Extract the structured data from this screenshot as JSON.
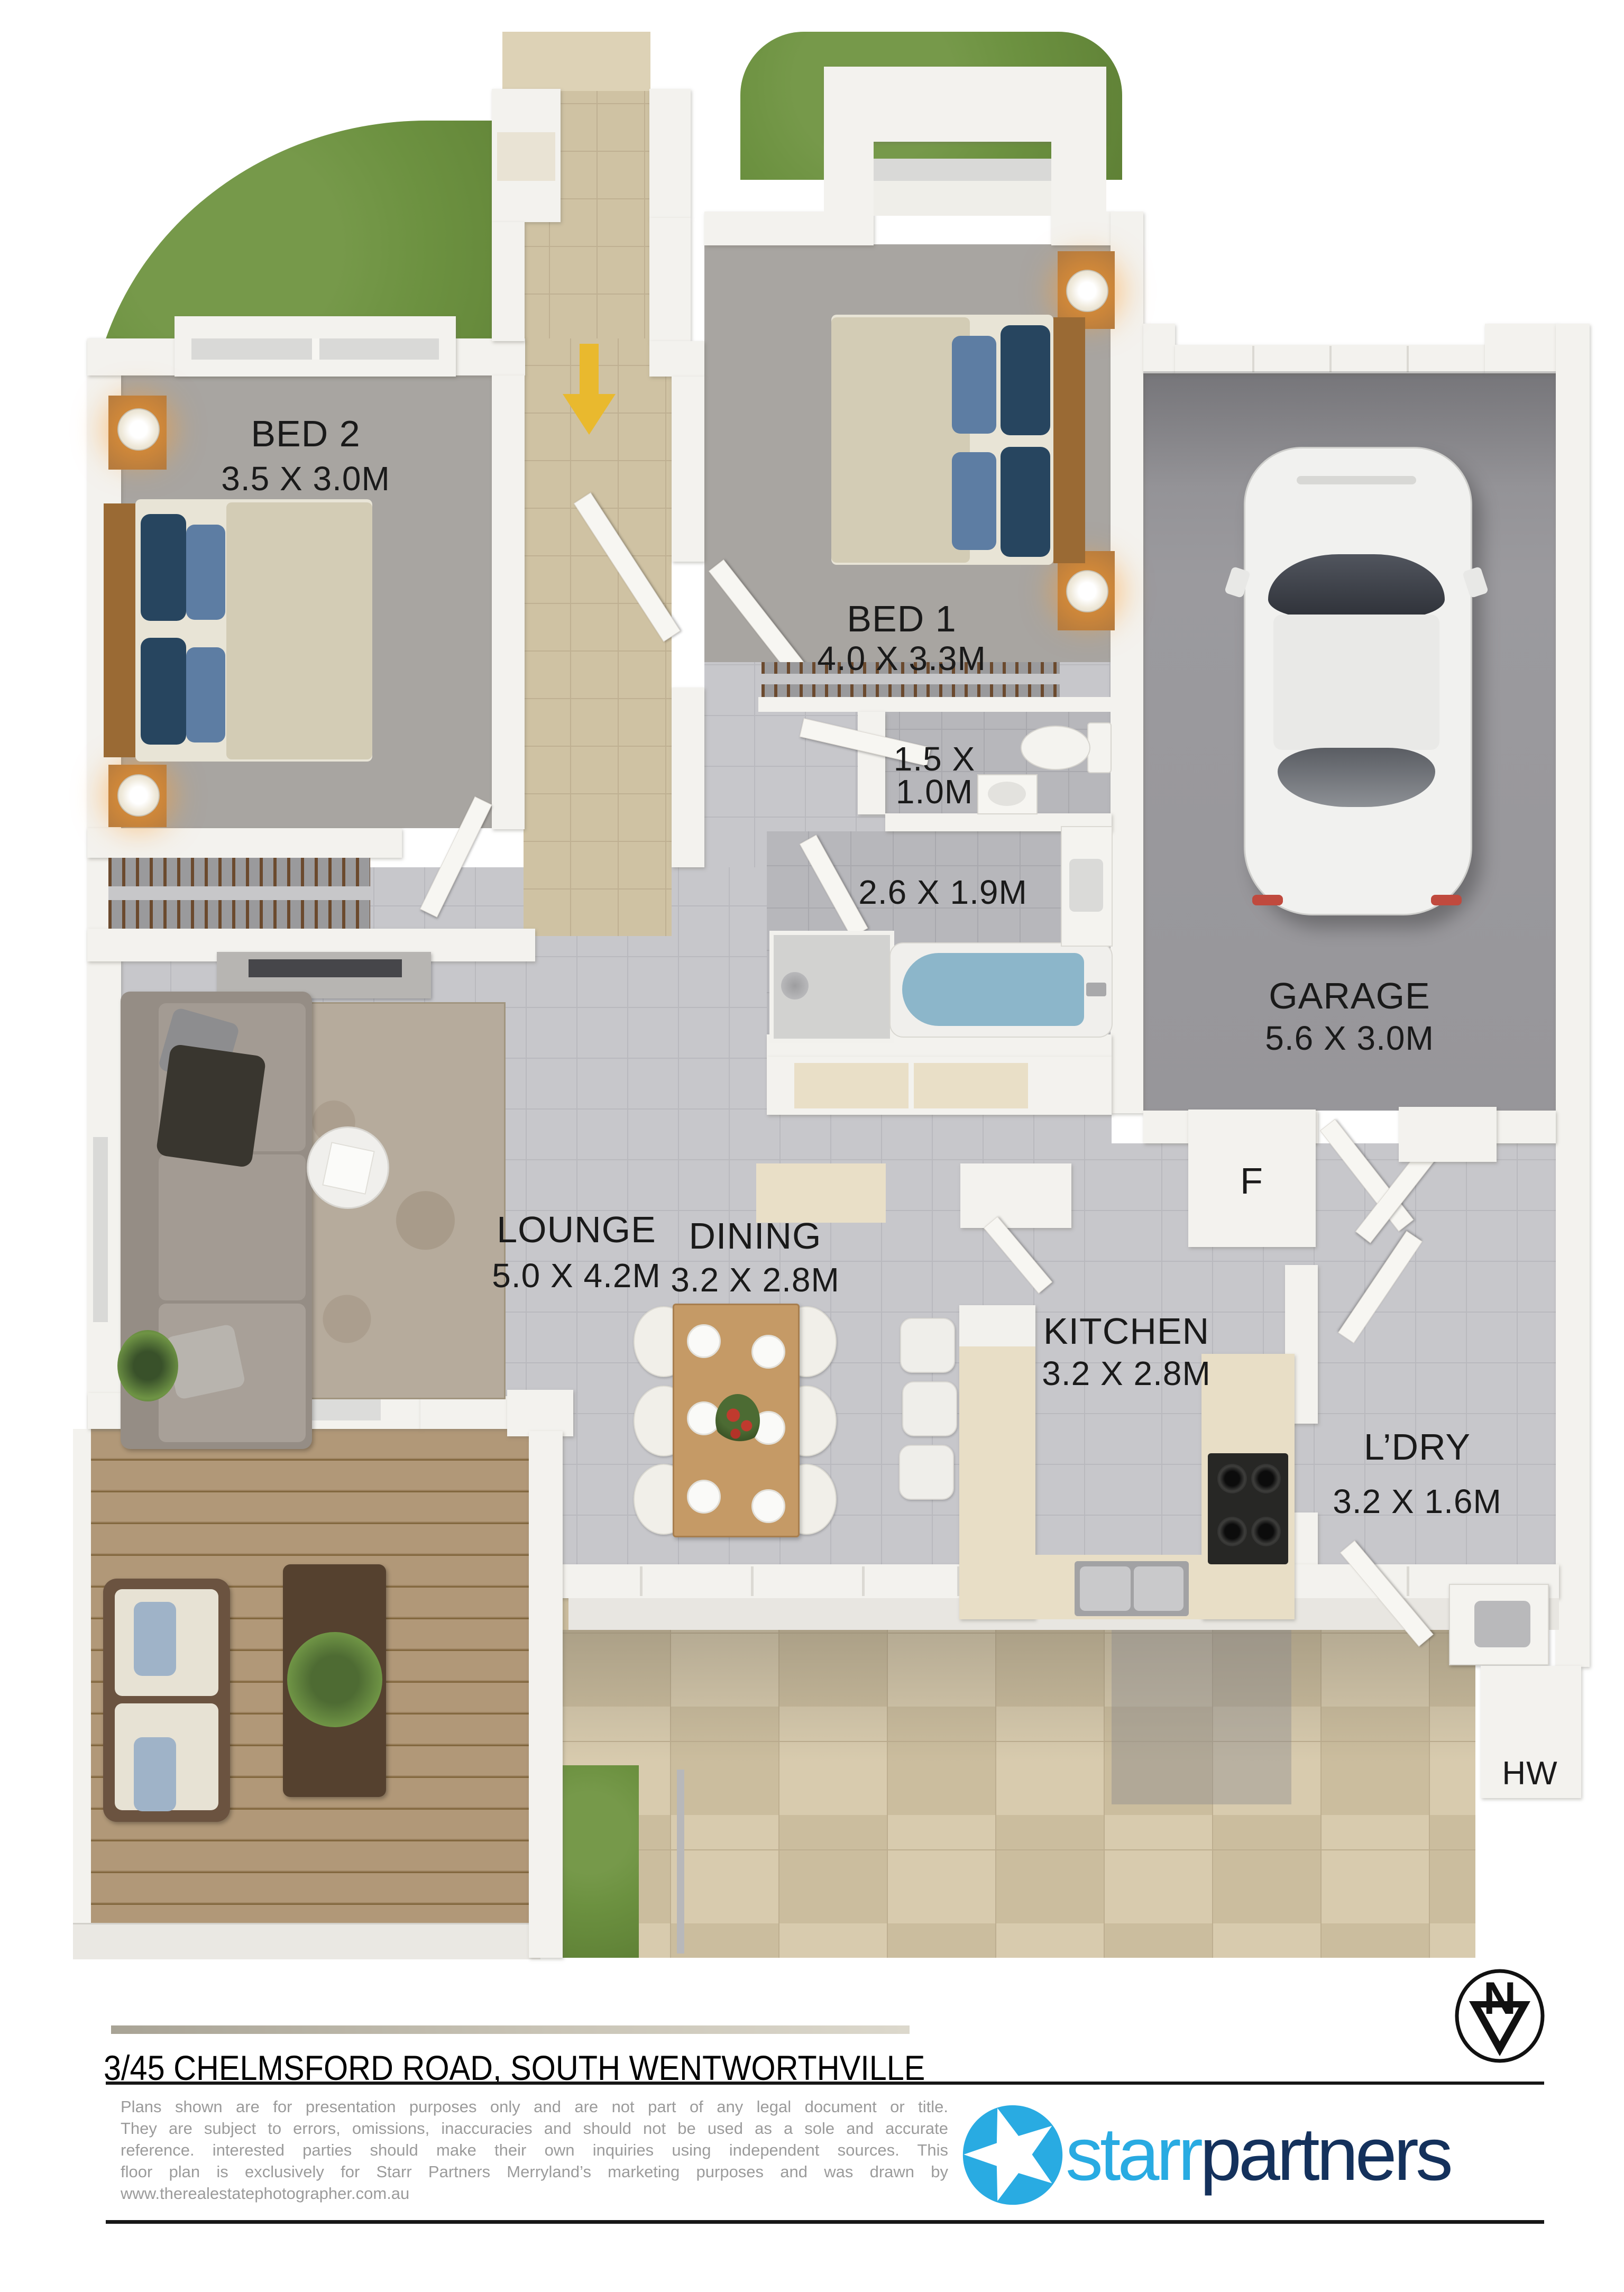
{
  "rooms": {
    "bed2": {
      "name": "BED 2",
      "dims": "3.5 X 3.0M"
    },
    "bed1": {
      "name": "BED 1",
      "dims": "4.0 X 3.3M"
    },
    "wc": {
      "dims_line1": "1.5 X",
      "dims_line2": "1.0M"
    },
    "bath": {
      "dims": "2.6 X 1.9M"
    },
    "garage": {
      "name": "GARAGE",
      "dims": "5.6 X 3.0M"
    },
    "lounge": {
      "name": "LOUNGE",
      "dims": "5.0 X 4.2M"
    },
    "dining": {
      "name": "DINING",
      "dims": "3.2 X 2.8M"
    },
    "kitchen": {
      "name": "KITCHEN",
      "dims": "3.2 X 2.8M"
    },
    "laundry": {
      "name": "L’DRY",
      "dims": "3.2 X 1.6M"
    }
  },
  "markers": {
    "fridge": "F",
    "hot_water": "HW",
    "north": "N"
  },
  "footer": {
    "address": "3/45 CHELMSFORD ROAD, SOUTH WENTWORTHVILLE",
    "disclaimer_lines": [
      "Plans shown are for presentation purposes only and are not part of any legal document or title.",
      "They are subject to errors, omissions, inaccuracies and should not be used as a sole and accurate",
      "reference. interested parties should make their own inquiries using independent sources. This",
      "floor plan is exclusively for Starr Partners Merryland’s marketing purposes and was drawn by",
      "www.therealestatephotographer.com.au"
    ],
    "logo_part1": "starr",
    "logo_part2": "partners"
  },
  "colors": {
    "logo_accent": "#29abe2",
    "logo_navy": "#14315c",
    "entry_arrow": "#e9b92e",
    "grass": "#6c9140",
    "bath_water": "#8cb6ca"
  }
}
